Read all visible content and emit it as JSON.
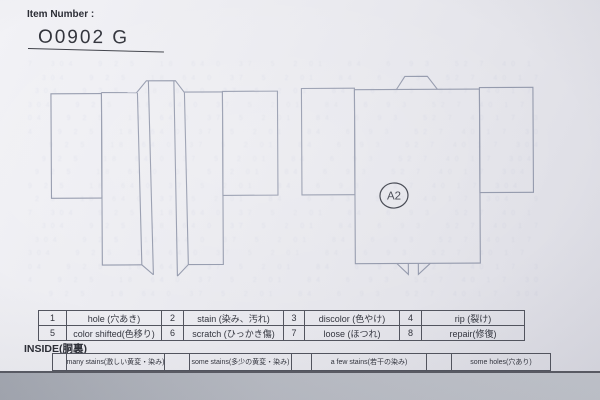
{
  "header": {
    "label": "Item Number :",
    "value": "O0902  G"
  },
  "diagrams": {
    "front": {
      "name": "kimono-front-outline"
    },
    "back": {
      "name": "kimono-back-outline",
      "annotation": "A2"
    }
  },
  "legend": {
    "items": [
      {
        "num": "1",
        "label": "hole (穴あき)"
      },
      {
        "num": "2",
        "label": "stain (染み、汚れ)"
      },
      {
        "num": "3",
        "label": "discolor (色やけ)"
      },
      {
        "num": "4",
        "label": "rip (裂け)"
      },
      {
        "num": "5",
        "label": "color shifted(色移り)"
      },
      {
        "num": "6",
        "label": "scratch (ひっかき傷)"
      },
      {
        "num": "7",
        "label": "loose (ほつれ)"
      },
      {
        "num": "8",
        "label": "repair(修復)"
      }
    ]
  },
  "inside": {
    "label": "INSIDE(胴裏)",
    "options": [
      "many stains(激しい黄変・染み)",
      "some stains(多少の黄変・染み)",
      "a few stains(若干の染み)",
      "some holes(穴あり)"
    ]
  },
  "colors": {
    "paper": "#e9e9ee",
    "diagram_line": "#9298ab",
    "table_line": "#53555f",
    "ink": "#2e3038",
    "background": "#b3b6bf"
  }
}
